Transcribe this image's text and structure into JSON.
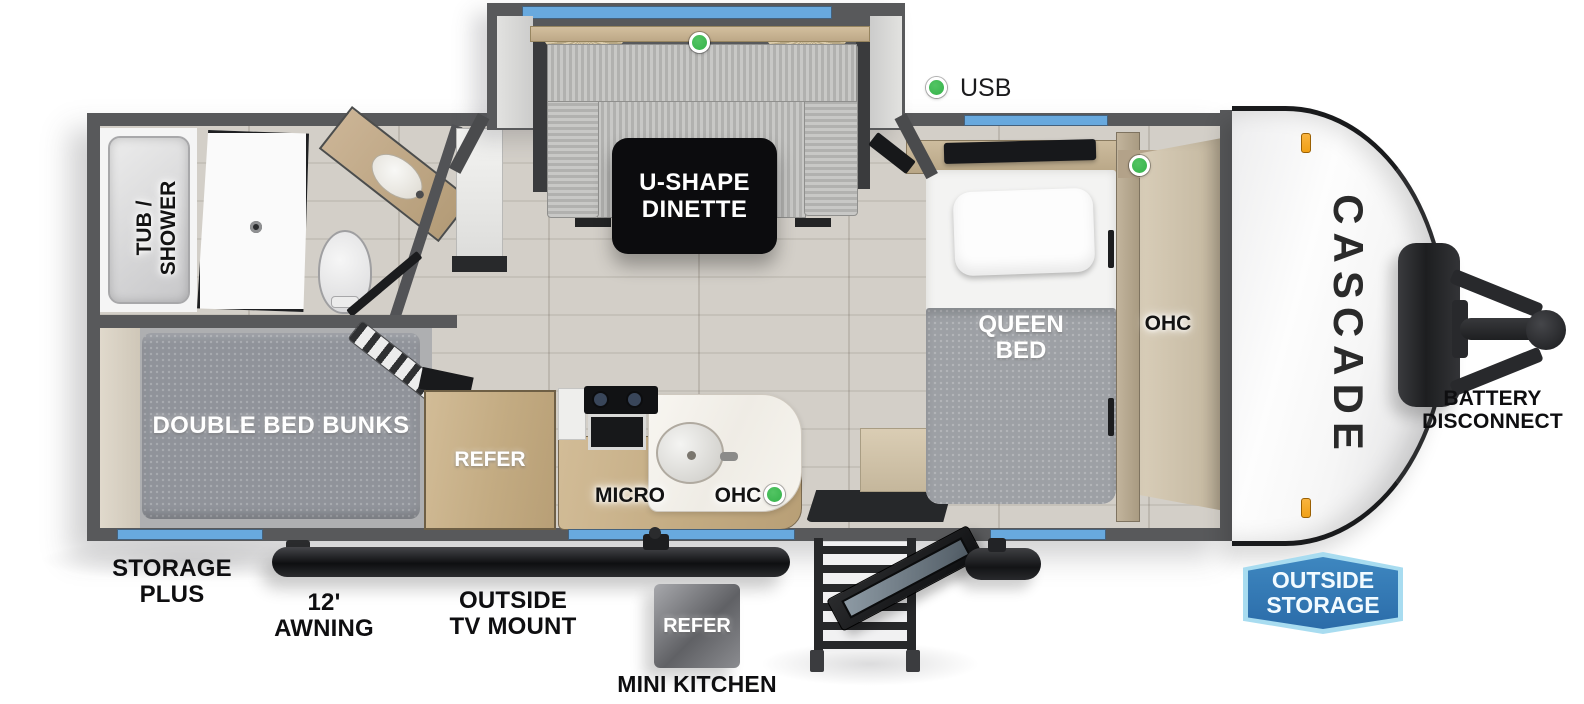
{
  "brand": {
    "name": "CASCADE"
  },
  "legend": {
    "usb": "USB"
  },
  "interior": {
    "dinette": {
      "line1": "U-SHAPE",
      "line2": "DINETTE"
    },
    "bathroom": {
      "tub_line1": "TUB /",
      "tub_line2": "SHOWER"
    },
    "bunkroom": {
      "bunks": "DOUBLE BED BUNKS"
    },
    "kitchen": {
      "refer": "REFER",
      "micro": "MICRO",
      "ohc": "OHC"
    },
    "bedroom": {
      "bed_line1": "QUEEN",
      "bed_line2": "BED",
      "ohc": "OHC"
    }
  },
  "exterior": {
    "storage_line1": "STORAGE",
    "storage_line2": "PLUS",
    "awning": "12' AWNING",
    "tv_line1": "OUTSIDE",
    "tv_line2": "TV MOUNT",
    "mini_refer": "REFER",
    "mini_kitchen": "MINI KITCHEN",
    "battery_line1": "BATTERY",
    "battery_line2": "DISCONNECT",
    "badge_line1": "OUTSIDE",
    "badge_line2": "STORAGE"
  },
  "colors": {
    "wall": "#58595b",
    "floor": "#d0ccc5",
    "window": "#68a9de",
    "marker": "#35b34a",
    "badge_fill": "#2b6ca9",
    "badge_border": "#a8dcf0",
    "clearance": "#f0a016"
  }
}
